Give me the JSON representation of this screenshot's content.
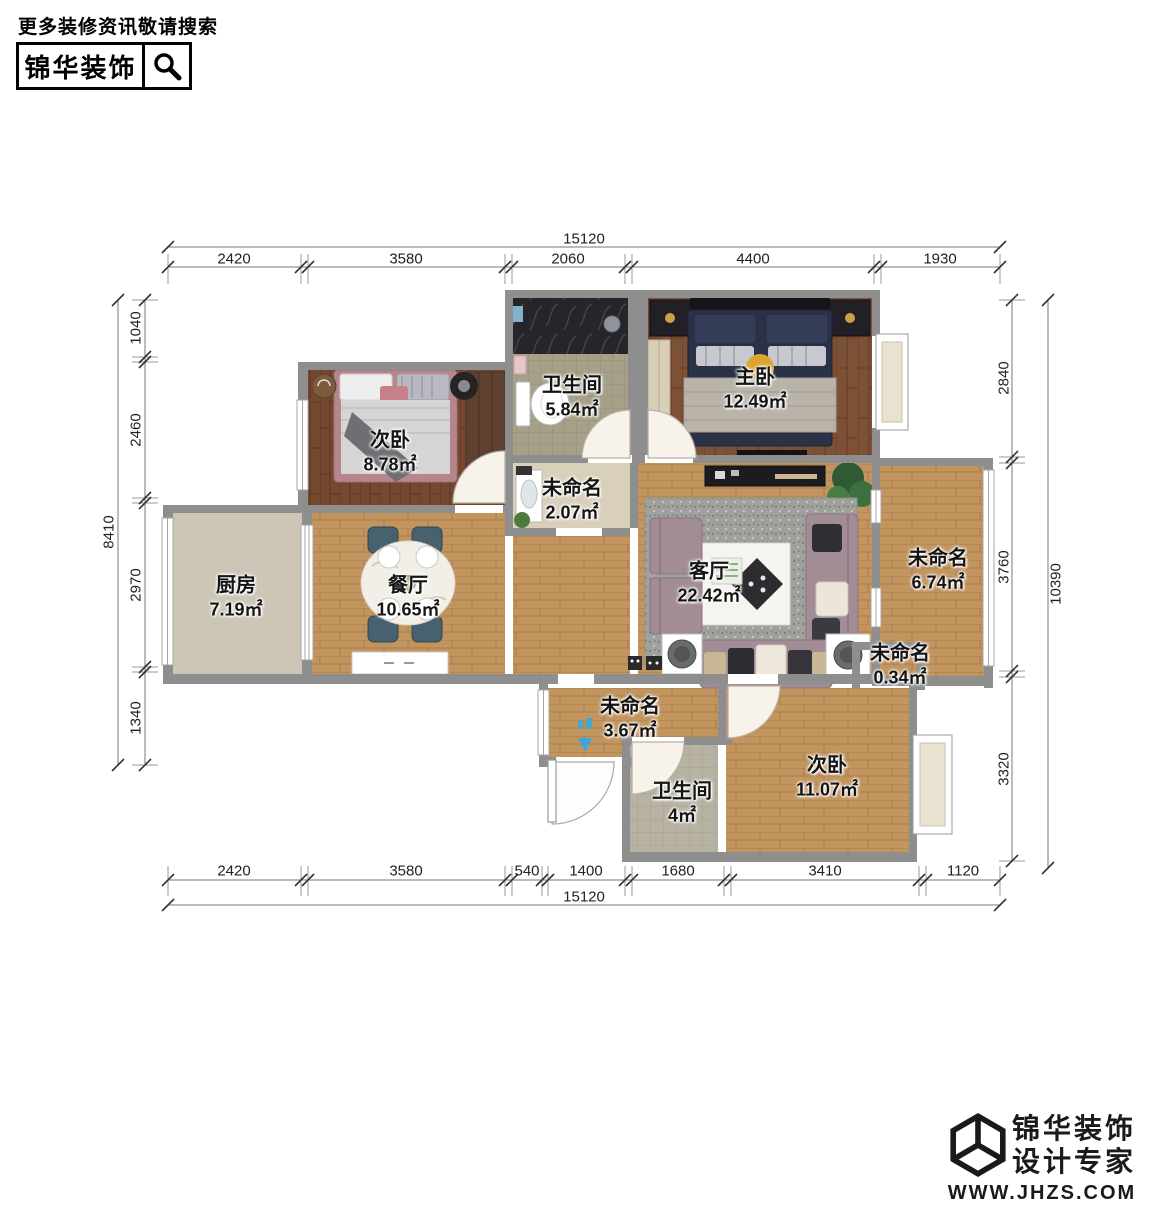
{
  "header": {
    "tagline": "更多装修资讯敬请搜索",
    "brand": "锦华装饰"
  },
  "rooms": [
    {
      "name": "次卧",
      "area": "8.78㎡"
    },
    {
      "name": "卫生间",
      "area": "5.84㎡"
    },
    {
      "name": "主卧",
      "area": "12.49㎡"
    },
    {
      "name": "未命名",
      "area": "2.07㎡"
    },
    {
      "name": "厨房",
      "area": "7.19㎡"
    },
    {
      "name": "餐厅",
      "area": "10.65㎡"
    },
    {
      "name": "客厅",
      "area": "22.42㎡"
    },
    {
      "name": "未命名",
      "area": "6.74㎡"
    },
    {
      "name": "未命名",
      "area": "0.34㎡"
    },
    {
      "name": "未命名",
      "area": "3.67㎡"
    },
    {
      "name": "卫生间",
      "area": "4㎡"
    },
    {
      "name": "次卧",
      "area": "11.07㎡"
    }
  ],
  "dims": {
    "top": {
      "total": "15120",
      "segments": [
        "2420",
        "3580",
        "2060",
        "4400",
        "1930"
      ]
    },
    "bottom": {
      "total": "15120",
      "segments": [
        "2420",
        "3580",
        "540",
        "1400",
        "1680",
        "3410",
        "1120"
      ]
    },
    "left": {
      "total": "8410",
      "segments": [
        "1040",
        "2460",
        "2970",
        "1340"
      ]
    },
    "right": {
      "total": "10390",
      "segments": [
        "2840",
        "3760",
        "3320"
      ]
    }
  },
  "footer": {
    "brand_line1": "锦华装饰",
    "brand_line2": "设计专家",
    "website": "WWW.JHZS.COM"
  },
  "colors": {
    "wall": "#8e8e8e",
    "wood_light": "#c79a63",
    "wood_dark": "#7b5137",
    "accent_blue": "#3aa8da"
  }
}
